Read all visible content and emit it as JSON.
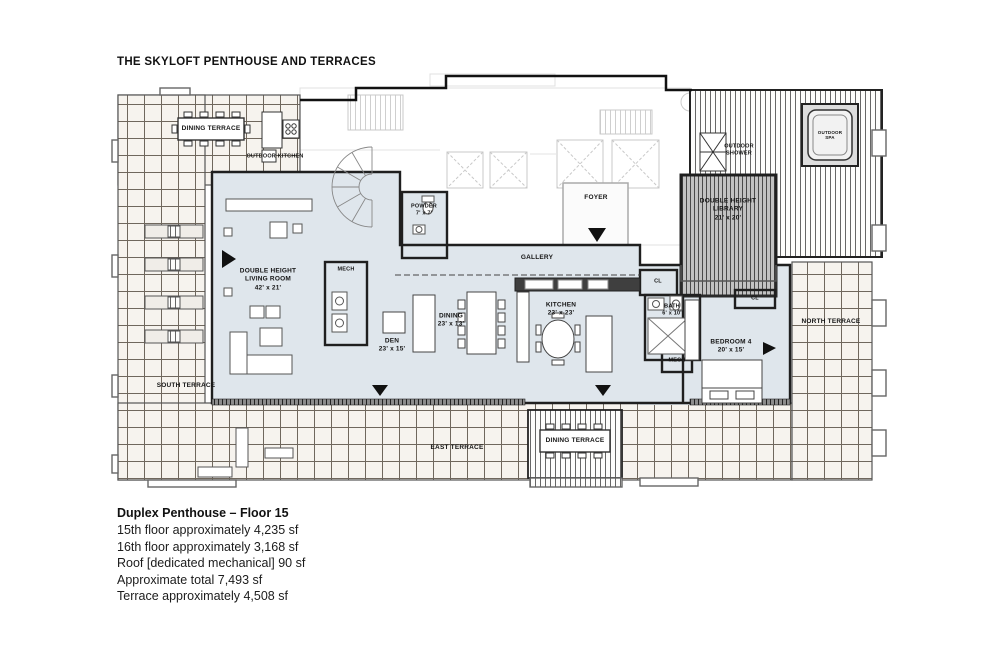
{
  "page": {
    "title": "THE SKYLOFT PENTHOUSE AND TERRACES"
  },
  "footer": {
    "heading": "Duplex Penthouse – Floor 15",
    "lines": [
      "15th floor approximately 4,235 sf",
      "16th floor approximately 3,168 sf",
      "Roof [dedicated mechanical] 90 sf",
      "Approximate total 7,493 sf",
      "Terrace approximately 4,508 sf"
    ]
  },
  "labels": {
    "dining_terrace_top": "DINING TERRACE",
    "outdoor_kitchen": "OUTDOOR KITCHEN",
    "south_terrace": "SOUTH TERRACE",
    "north_terrace": "NORTH TERRACE",
    "east_terrace": "EAST TERRACE",
    "dining_terrace_bottom": "DINING TERRACE",
    "living_room": "DOUBLE HEIGHT\nLIVING ROOM\n42' x 21'",
    "mech_a": "MECH",
    "powder": "POWDER\n7' x 7'",
    "foyer": "FOYER",
    "gallery": "GALLERY",
    "den": "DEN\n23' x 15'",
    "dining": "DINING\n23' x 13'",
    "kitchen": "KITCHEN\n23' x 23'",
    "library": "DOUBLE HEIGHT\nLIBRARY\n21' x 20'",
    "outdoor_shower": "OUTDOOR\nSHOWER",
    "outdoor_spa": "OUTDOOR\nSPA",
    "closet_a": "CL",
    "closet_b": "CL",
    "bath": "BATH\n6' x 10'",
    "mech_b": "MECH",
    "bedroom4": "BEDROOM 4\n20' x 15'"
  },
  "colors": {
    "interior_floor": "#dfe6ec",
    "terrace_tile": "#f6f3ee",
    "tile_line": "#6f675d",
    "deck_stripe": "#666666",
    "wall": "#1f1f1f",
    "core_faded": "#c9c9c9"
  }
}
